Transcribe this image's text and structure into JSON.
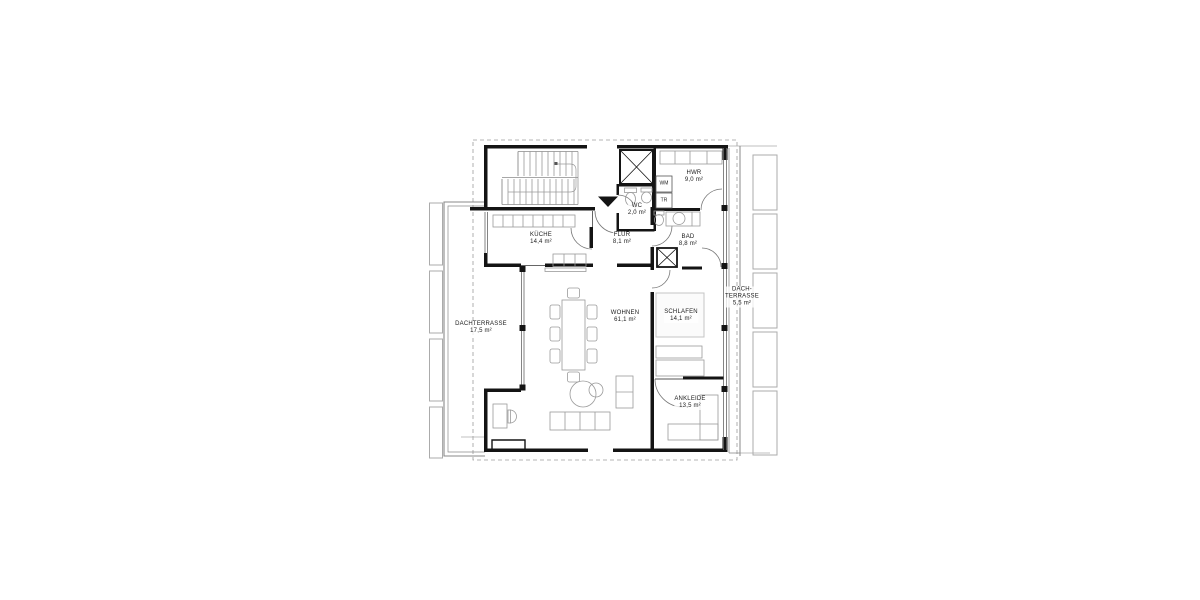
{
  "drawing": {
    "kind": "architectural floor plan",
    "language": "German"
  },
  "rooms": [
    {
      "id": "kueche",
      "name": "KÜCHE",
      "area": "14,4 m²"
    },
    {
      "id": "flur",
      "name": "FLUR",
      "area": "8,1 m²"
    },
    {
      "id": "wc",
      "name": "WC",
      "area": "2,0 m²"
    },
    {
      "id": "hwr",
      "name": "HWR",
      "area": "9,0 m²"
    },
    {
      "id": "bad",
      "name": "BAD",
      "area": "8,8 m²"
    },
    {
      "id": "wohnen",
      "name": "WOHNEN",
      "area": "61,1 m²"
    },
    {
      "id": "schlafen",
      "name": "SCHLAFEN",
      "area": "14,1 m²"
    },
    {
      "id": "ankleide",
      "name": "ANKLEIDE",
      "area": "13,5 m²"
    },
    {
      "id": "dachterrasse_west",
      "name": "DACHTERRASSE",
      "area": "17,5 m²"
    },
    {
      "id": "dachterrasse_east",
      "name": "DACH-TERRASSE",
      "area": "5,5 m²"
    }
  ],
  "appliance_labels": {
    "washing_machine": "WM",
    "dryer": "TR"
  },
  "colors": {
    "wall": "#141414",
    "structure_line": "#666666",
    "furniture_line": "#9a9a9a",
    "rail_line": "#8a8a8a",
    "exterior_line": "#ababab",
    "boundary_dash": "#9c9c9c",
    "background": "#ffffff"
  }
}
